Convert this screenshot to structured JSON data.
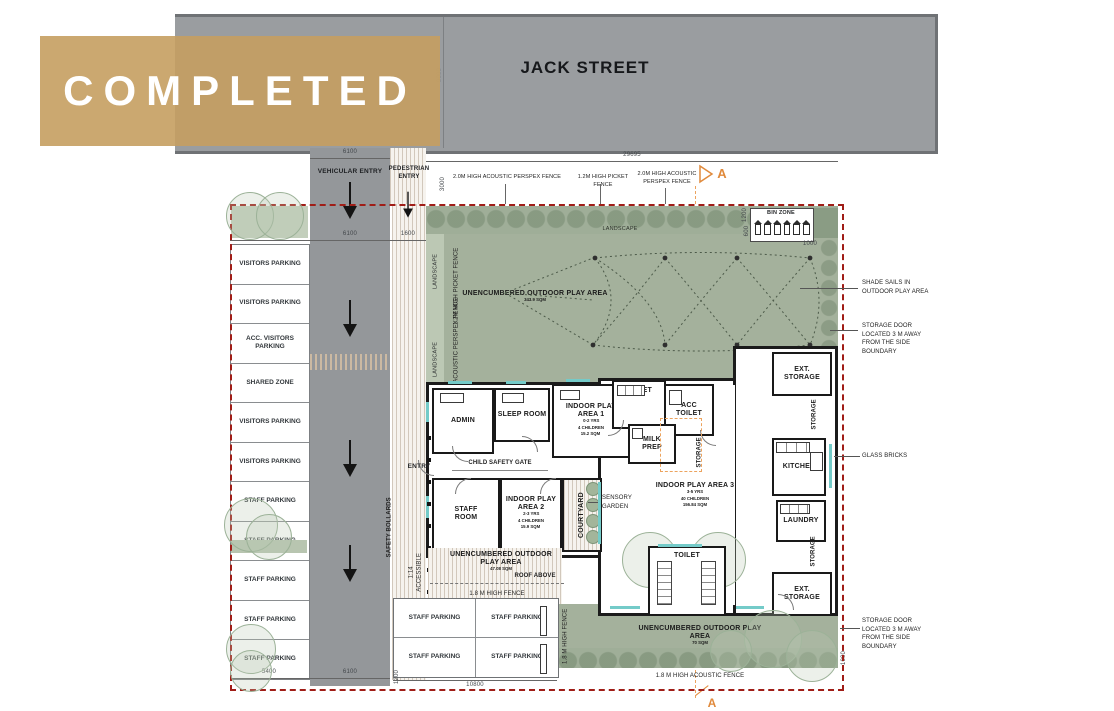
{
  "banner": {
    "label": "COMPLETED"
  },
  "street": {
    "name": "JACK STREET"
  },
  "entries": {
    "vehicular": "VEHICULAR ENTRY",
    "pedestrian": "PEDESTRIAN ENTRY",
    "entry": "ENTRY",
    "child_safety_gate": "CHILD SAFETY GATE"
  },
  "fences": {
    "acoustic_perspex_a": "2.0M HIGH ACOUSTIC PERSPEX FENCE",
    "picket": "1.2M HIGH PICKET FENCE",
    "acoustic_perspex_b": "2.0M HIGH ACOUSTIC PERSPEX FENCE",
    "picket_side": "1.2M HIGH PICKET FENCE",
    "acoustic_perspex_side": "2.0M HIGH ACOUSTIC PERSPEX FENCE",
    "fence_18_west": "1.8 M HIGH FENCE",
    "fence_18_east": "1.8 M HIGH FENCE",
    "acoustic_18_south": "1.8 M HIGH ACOUSTIC FENCE"
  },
  "site": {
    "landscape_top": "LANDSCAPE",
    "landscape_side1": "LANDSCAPE",
    "landscape_side2": "LANDSCAPE",
    "bin_zone": "BIN ZONE",
    "safety_bollards": "SAFETY BOLLARDS",
    "roof_above": "ROOF ABOVE",
    "accessible": "ACCESSIBLE",
    "ramp_grade": "1:14",
    "section": "A"
  },
  "annotations": {
    "shade_sails": "SHADE SAILS IN OUTDOOR PLAY AREA",
    "storage_door_top": "STORAGE DOOR LOCATED 3 M AWAY FROM THE SIDE BOUNDARY",
    "glass_bricks": "GLASS BRICKS",
    "storage_door_bottom": "STORAGE DOOR LOCATED 3 M AWAY FROM THE SIDE BOUNDARY"
  },
  "outdoor_areas": {
    "north": {
      "name": "UNENCUMBERED OUTDOOR PLAY AREA",
      "sqm": "343.9 SQM"
    },
    "west": {
      "name": "UNENCUMBERED OUTDOOR PLAY AREA",
      "sqm": "47.08 SQM"
    },
    "south": {
      "name": "UNENCUMBERED OUTDOOR PLAY AREA",
      "sqm": "70 SQM"
    }
  },
  "rooms": {
    "admin": "ADMIN",
    "sleep": "SLEEP ROOM",
    "play1": {
      "name": "INDOOR PLAY AREA 1",
      "age": "0-2 YRS",
      "cap": "4 CHILDREN",
      "sqm": "15.2 SQM"
    },
    "toilet_n": "TOILET",
    "acc_toilet": "ACC TOILET",
    "milk_prep": "MILK PREP",
    "staff_room": "STAFF ROOM",
    "play2": {
      "name": "INDOOR PLAY AREA 2",
      "age": "2-3 YRS",
      "cap": "4 CHILDREN",
      "sqm": "15.9 SQM"
    },
    "courtyard": "COURTYARD",
    "sensory_garden": "SENSORY GARDEN",
    "play3": {
      "name": "INDOOR PLAY AREA 3",
      "age": "3-5 YRS",
      "cap": "40 CHILDREN",
      "sqm": "156.84 SQM"
    },
    "toilet_s": "TOILET",
    "kitchen": "KITCHEN",
    "laundry": "LAUNDRY",
    "ext_storage_n": "EXT. STORAGE",
    "ext_storage_s": "EXT. STORAGE",
    "storage_1": "STORAGE",
    "storage_2": "STORAGE",
    "storage_3": "STORAGE"
  },
  "parking": {
    "left": [
      "VISITORS PARKING",
      "VISITORS PARKING",
      "ACC. VISITORS PARKING",
      "SHARED ZONE",
      "VISITORS PARKING",
      "VISITORS PARKING",
      "STAFF PARKING",
      "STAFF PARKING",
      "STAFF PARKING",
      "STAFF PARKING",
      "STAFF PARKING"
    ],
    "south": [
      "STAFF PARKING",
      "STAFF PARKING",
      "STAFF PARKING",
      "STAFF PARKING"
    ]
  },
  "dimensions": {
    "top_6100": "6100",
    "top_29695": "29695",
    "top_3000": "3000",
    "street_width": "9000",
    "row_5400": "5400",
    "row_6100": "6100",
    "row_1600": "1600",
    "v_1200_ped": "1200",
    "v_1200_bin": "1200",
    "v_600_bin": "600",
    "h_1000_bin": "1000",
    "bot_5400": "5400",
    "bot_6100": "6100",
    "bot_10800": "10800",
    "bot_1200": "1200",
    "v_1000_se": "1000"
  },
  "colors": {
    "banner": "#c59e60",
    "street": "#9a9da0",
    "play_green": "#a4b19c",
    "boundary_red": "#a01d17",
    "section_orange": "#e08a3c",
    "window_teal": "#74cbc9"
  }
}
